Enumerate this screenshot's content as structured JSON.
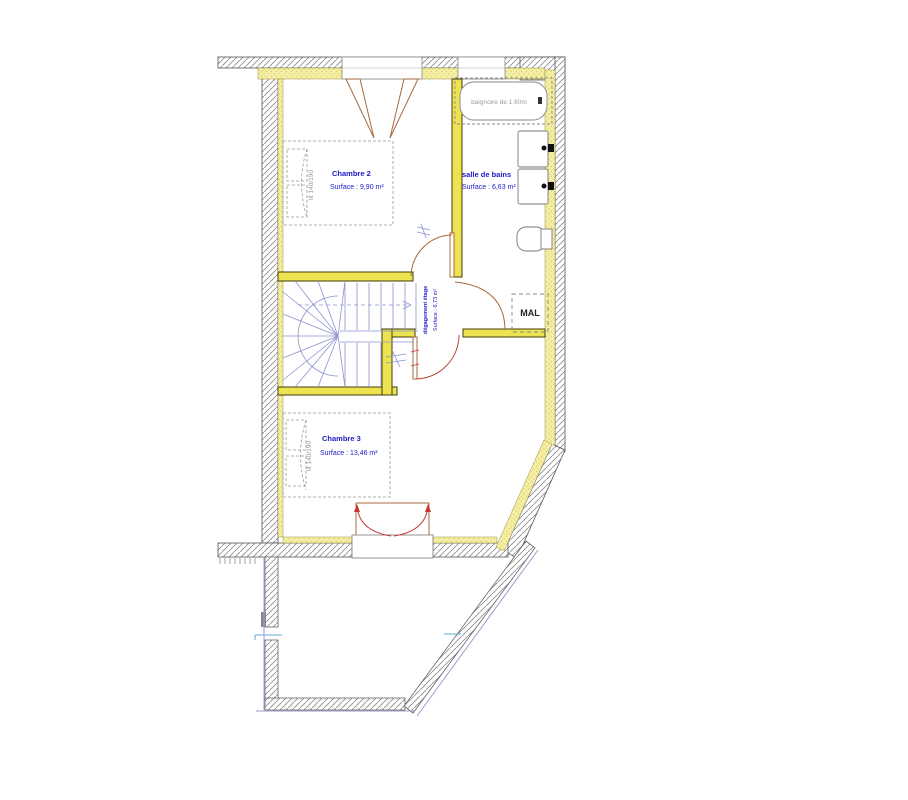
{
  "rooms": [
    {
      "name": "Chambre 2",
      "surface": "Surface : 9,90 m²"
    },
    {
      "name": "salle de bains",
      "surface": "Surface : 6,63 m²"
    },
    {
      "name": "dégagement étage",
      "surface": "Surface : 6,73 m²"
    },
    {
      "name": "Chambre 3",
      "surface": "Surface : 13,46 m²"
    }
  ],
  "fixtures": {
    "bathtub_label": "baignoire de 1,60m",
    "washing_machine_label": "MAL",
    "bed_label": "lit 140/190"
  },
  "colors": {
    "label_blue": "#1a1aca",
    "partition_yellow": "#ede24f",
    "lining_yellow": "#f4efa4",
    "door_brown": "#a8693a",
    "door_red": "#c93434",
    "stair_blue": "#8a92cc",
    "hatch_gray": "#8a8a8a",
    "terrace_lavender": "#9a9ece",
    "text_gray": "#9a9a9a"
  }
}
